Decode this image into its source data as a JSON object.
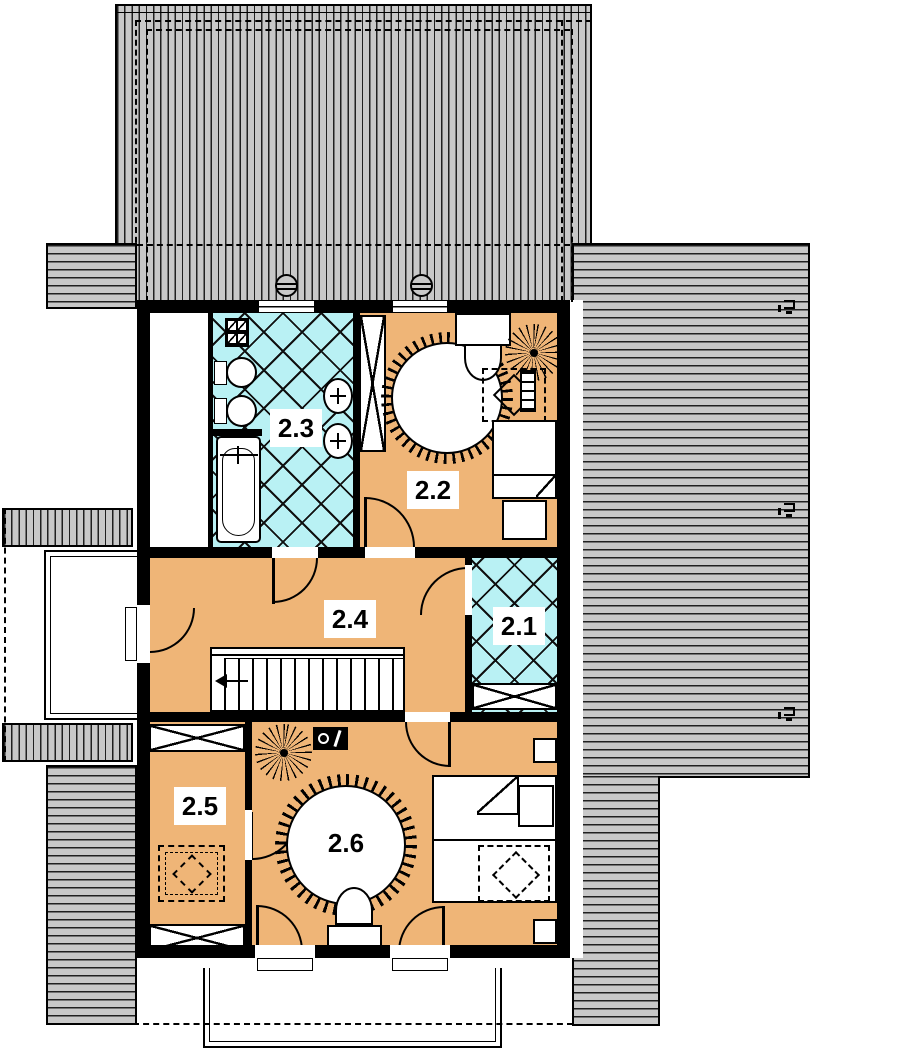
{
  "colors": {
    "roof": "#c8c8c8",
    "floor_orange": "#efb577",
    "tile_cyan": "#b9f1f4",
    "wall": "#000000",
    "background": "#ffffff"
  },
  "rooms": [
    {
      "label": "2.1",
      "floor": "tile",
      "furniture": [
        "wardrobe"
      ]
    },
    {
      "label": "2.2",
      "floor": "wood",
      "furniture": [
        "wardrobe",
        "round-rug",
        "desk",
        "chair",
        "plant",
        "skylight-table",
        "shelf",
        "bed",
        "pillow"
      ]
    },
    {
      "label": "2.3",
      "floor": "tile",
      "furniture": [
        "washing-machine",
        "toilet",
        "toilet",
        "bathtub",
        "washbasin",
        "washbasin"
      ]
    },
    {
      "label": "2.4",
      "floor": "wood",
      "furniture": [
        "staircase"
      ]
    },
    {
      "label": "2.5",
      "floor": "wood",
      "furniture": [
        "wardrobe",
        "wardrobe",
        "skylight-table"
      ]
    },
    {
      "label": "2.6",
      "floor": "wood",
      "furniture": [
        "plant",
        "tv",
        "round-rug",
        "chair",
        "desk",
        "double-bed",
        "skylight-table",
        "nightstand",
        "nightstand"
      ]
    }
  ],
  "exterior": {
    "balconies": 2,
    "roof_vents": 2,
    "roof_window_markers": 3
  }
}
